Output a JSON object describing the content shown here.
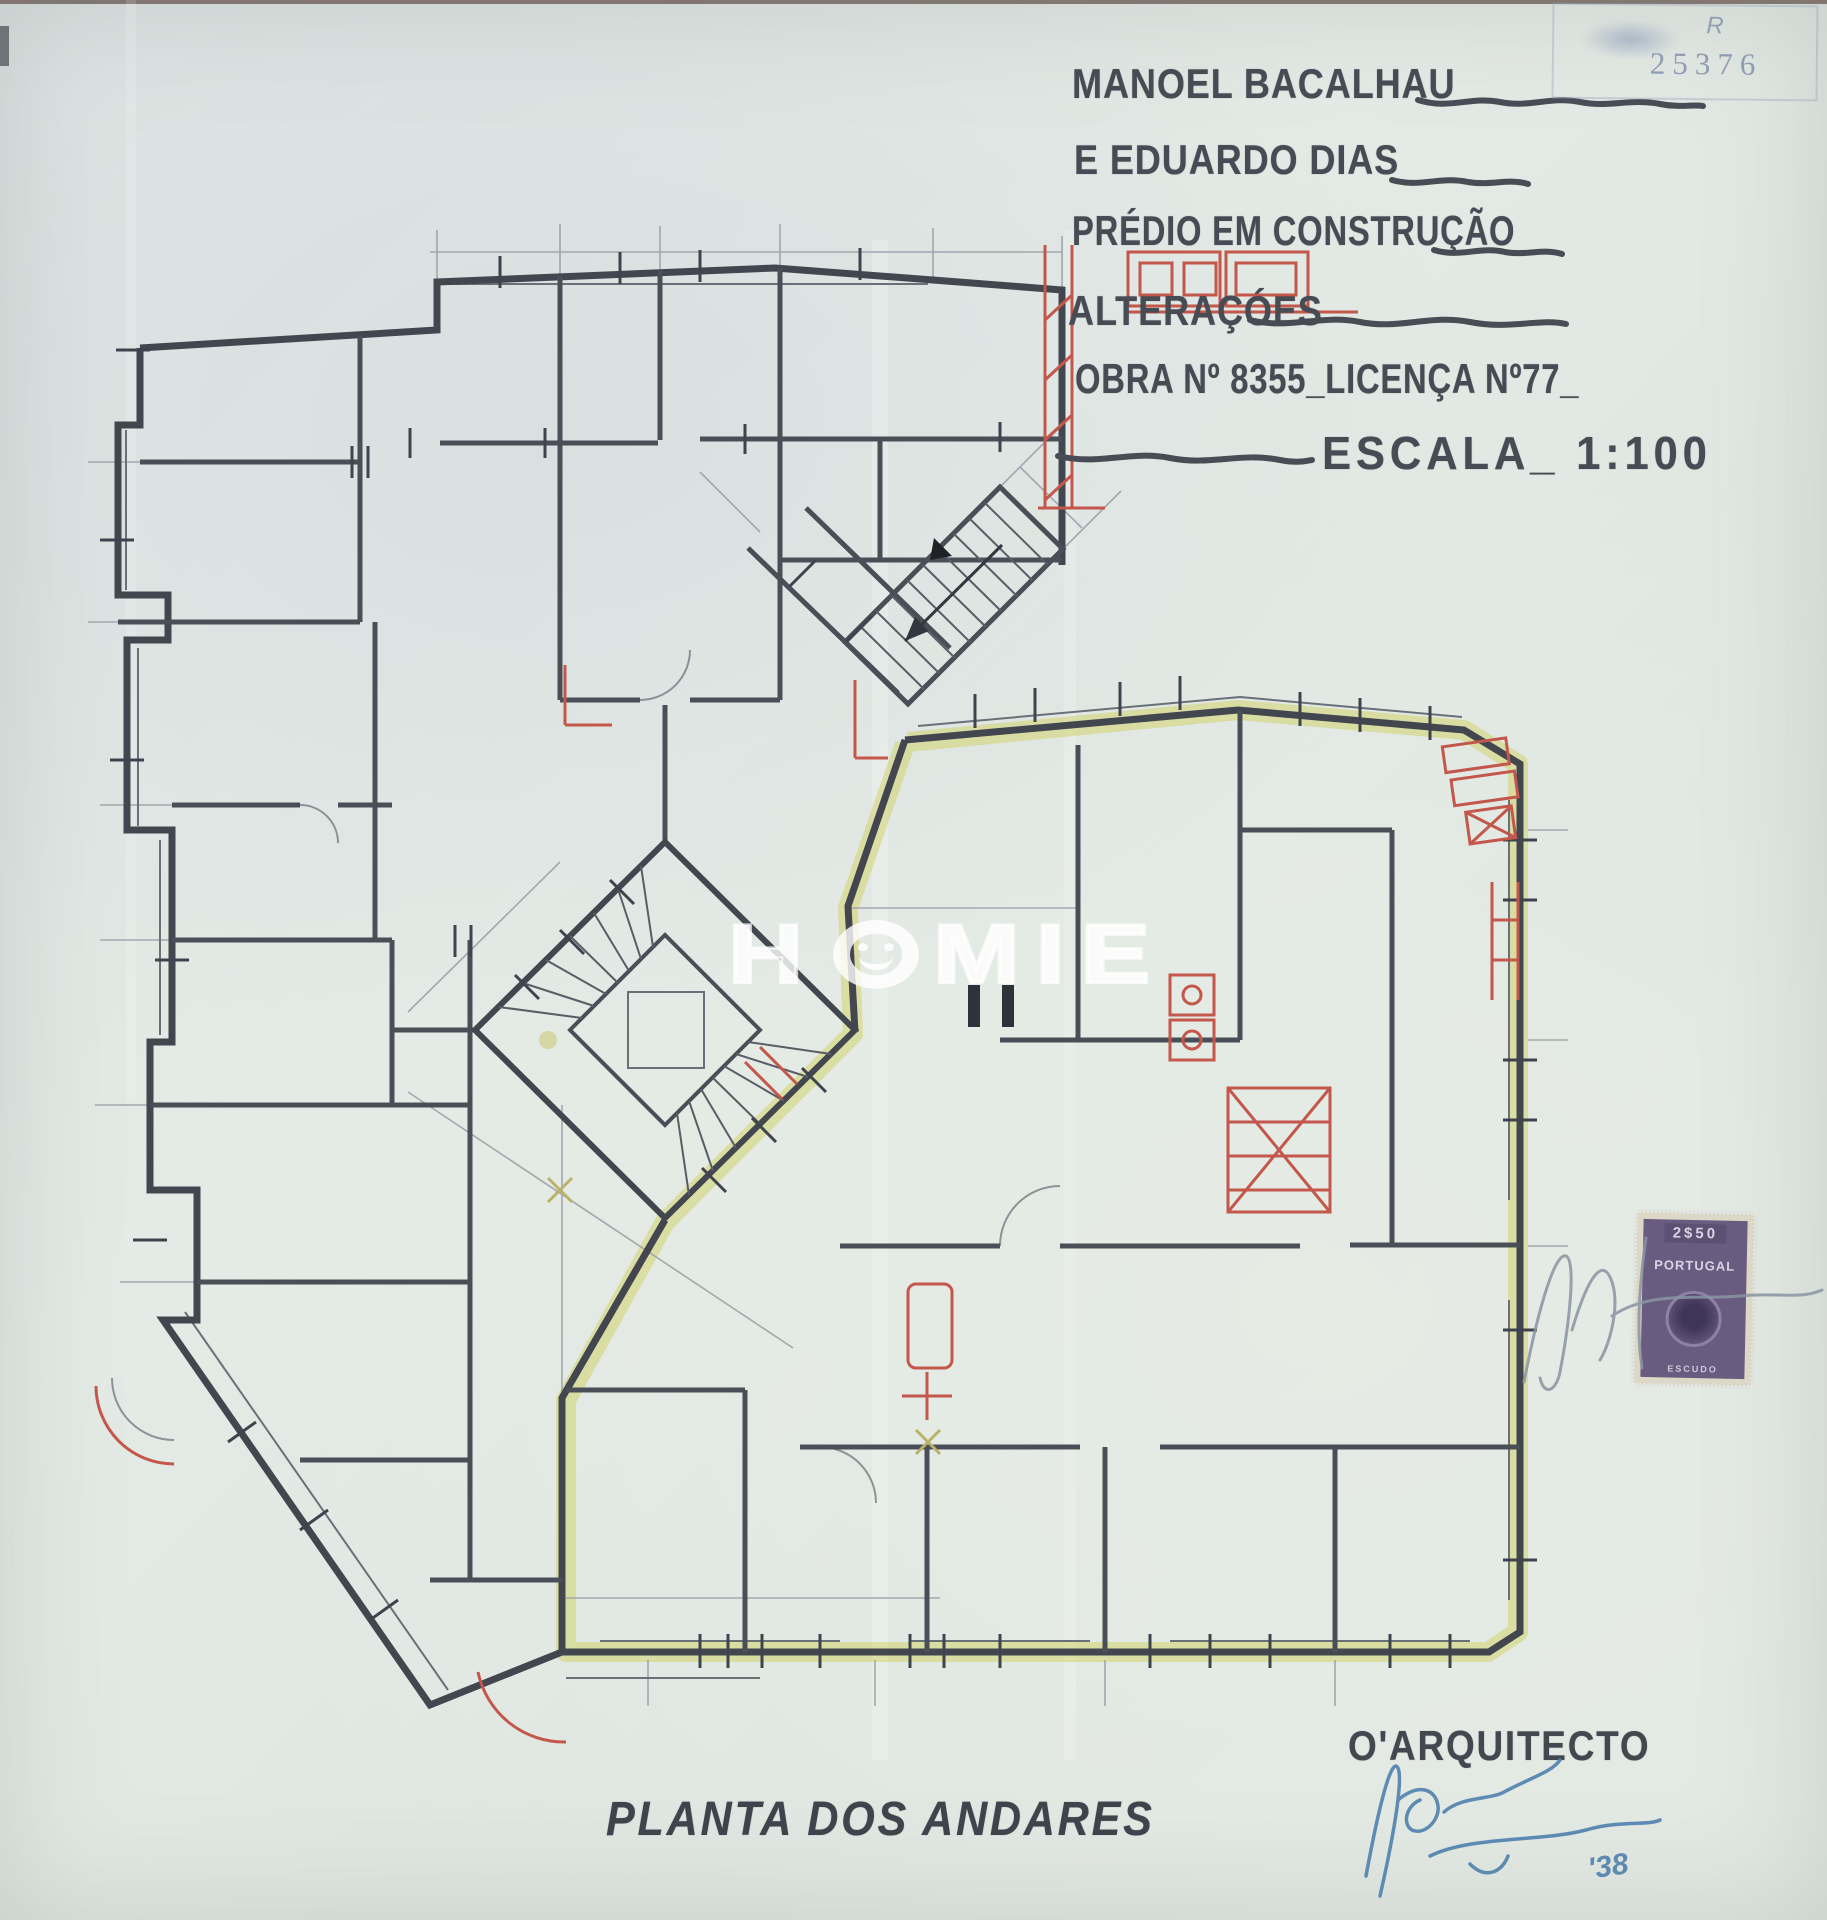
{
  "title_block": {
    "line1": "MANOEL BACALHAU",
    "line2": "E EDUARDO DIAS",
    "line3": "PRÉDIO EM CONSTRUÇÃO",
    "line4": "ALTERAÇÓES",
    "line5": "OBRA Nº 8355_LICENÇA Nº77_",
    "line6": "ESCALA_ 1:100"
  },
  "registry_stamp": {
    "letter": "R",
    "number": "25376"
  },
  "revenue_stamp": {
    "serial": "2$50",
    "country": "PORTUGAL",
    "denomination": "ESCUDO"
  },
  "watermark": {
    "full": "HOMIE",
    "part1": "H",
    "part2": "MIE"
  },
  "footer": {
    "caption": "PLANTA DOS ANDARES",
    "architect_label": "O'ARQUITECTO",
    "signature_year": "'38"
  },
  "drawing": {
    "scale": "1:100",
    "highlight_color": "#d4d46e",
    "correction_color": "#c4574b",
    "ink_color": "#42464f",
    "signature_ink": "#4f81ad"
  }
}
